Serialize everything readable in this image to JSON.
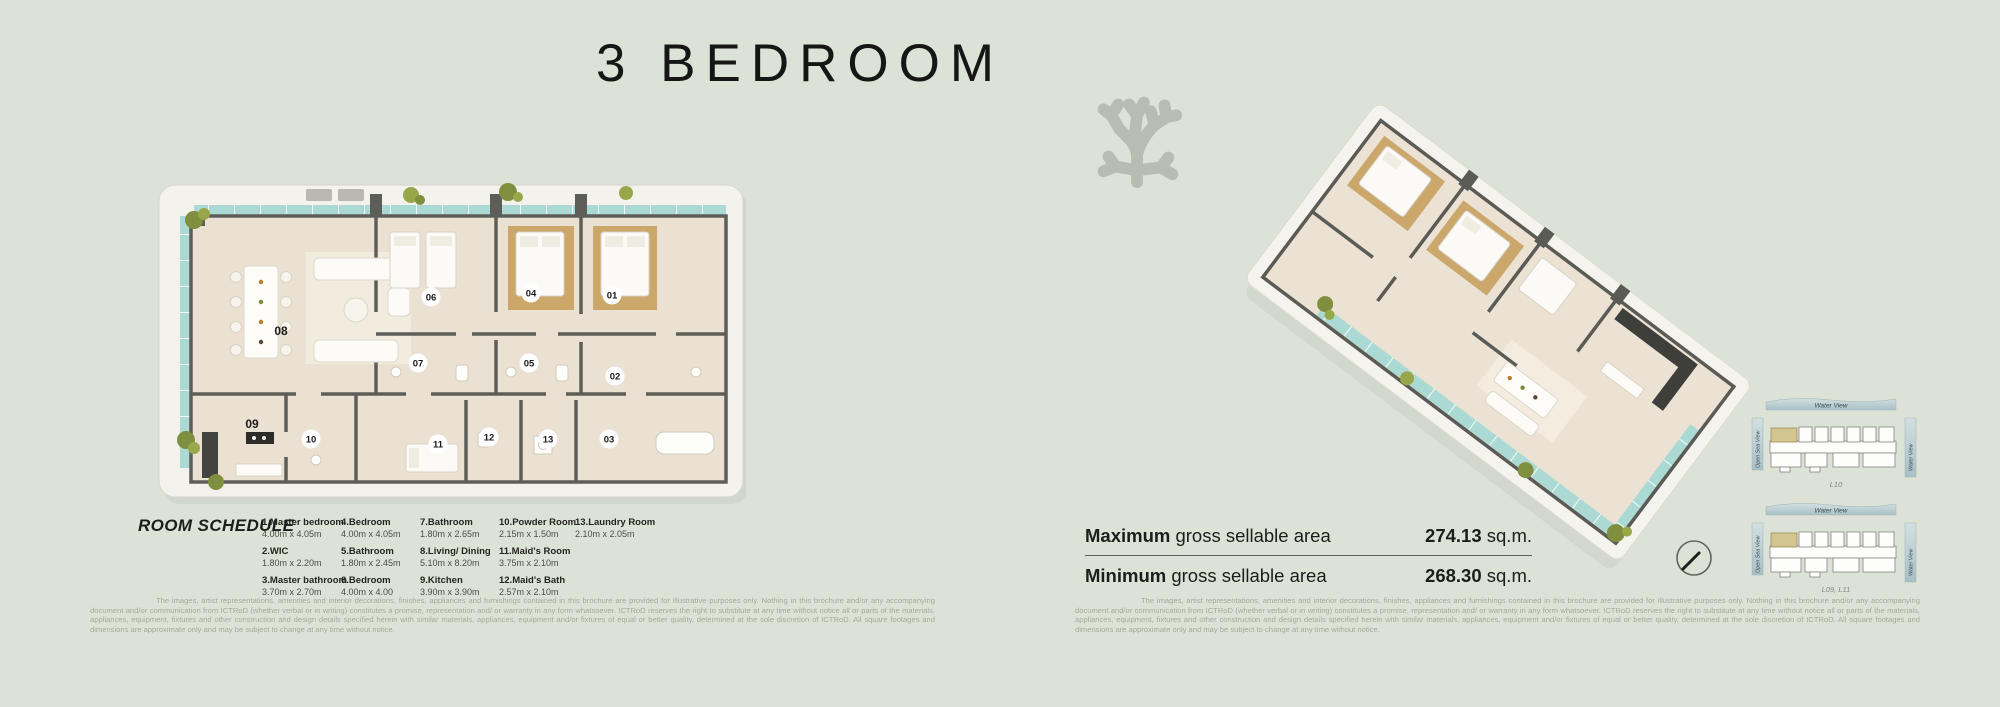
{
  "title": "3 BEDROOM",
  "room_schedule": {
    "heading": "ROOM SCHEDULE",
    "columns": [
      [
        {
          "name": "1.Master bedroom",
          "dims": "4.00m x 4.05m"
        },
        {
          "name": "2.WIC",
          "dims": "1.80m x 2.20m"
        },
        {
          "name": "3.Master bathroom",
          "dims": "3.70m x 2.70m"
        }
      ],
      [
        {
          "name": "4.Bedroom",
          "dims": "4.00m x 4.05m"
        },
        {
          "name": "5.Bathroom",
          "dims": "1.80m x 2.45m"
        },
        {
          "name": "6.Bedroom",
          "dims": "4.00m x 4.00"
        }
      ],
      [
        {
          "name": "7.Bathroom",
          "dims": "1.80m x 2.65m"
        },
        {
          "name": "8.Living/ Dining",
          "dims": "5.10m x 8.20m"
        },
        {
          "name": "9.Kitchen",
          "dims": "3.90m x 3.90m"
        }
      ],
      [
        {
          "name": "10.Powder Room",
          "dims": "2.15m x 1.50m"
        },
        {
          "name": "11.Maid's Room",
          "dims": "3.75m x 2.10m"
        },
        {
          "name": "12.Maid's Bath",
          "dims": "2.57m x 2.10m"
        }
      ],
      [
        {
          "name": "13.Laundry Room",
          "dims": "2.10m x 2.05m"
        }
      ]
    ]
  },
  "floor_plan": {
    "labels": [
      "01",
      "02",
      "03",
      "04",
      "05",
      "06",
      "07",
      "08",
      "09",
      "10",
      "11",
      "12",
      "13"
    ]
  },
  "areas": {
    "maximum_label_bold": "Maximum",
    "maximum_label_rest": " gross sellable area",
    "maximum_value": "274.13",
    "maximum_unit": " sq.m.",
    "minimum_label_bold": "Minimum",
    "minimum_label_rest": " gross sellable area",
    "minimum_value": "268.30",
    "minimum_unit": " sq.m."
  },
  "key_plans": [
    {
      "top": "Water View",
      "left": "Open Sea View",
      "right": "Water View",
      "floors": "L10"
    },
    {
      "top": "Water View",
      "left": "Open Sea View",
      "right": "Water View",
      "floors": "L09, L11"
    }
  ],
  "disclaimer": "The images, artist representations, amenities and interior decorations, finishes, appliances and furnishings contained in this brochure are provided for illustrative purposes only. Nothing in this brochure and/or any accompanying document and/or communication from ICTRoD (whether verbal or in writing) constitutes a promise, representation and/ or warranty in any form whatsoever. ICTRoD reserves the right to substitute at any time without notice all or parts of the materials, appliances, equipment, fixtures and other construction and design details specified herein with similar materials, appliances, equipment and/or fixtures of equal or better quality, determined at the sole discretion of ICTRoD. All square footages and dimensions are approximate only and may be subject to change at any time without notice.",
  "icons": {
    "coral": "coral-silhouette",
    "compass": "north-compass"
  },
  "colors": {
    "background": "#dde2d7",
    "wall": "#5e5e59",
    "floor": "#eae1d2",
    "water_glass": "#abd9d4",
    "carpet": "#c79c58",
    "slab": "#f3f2ec",
    "highlight_unit": "#d4c48f",
    "ribbon": "#b9cdd1",
    "coral": "#b7beb1",
    "muted_text": "#a3ab9c"
  }
}
